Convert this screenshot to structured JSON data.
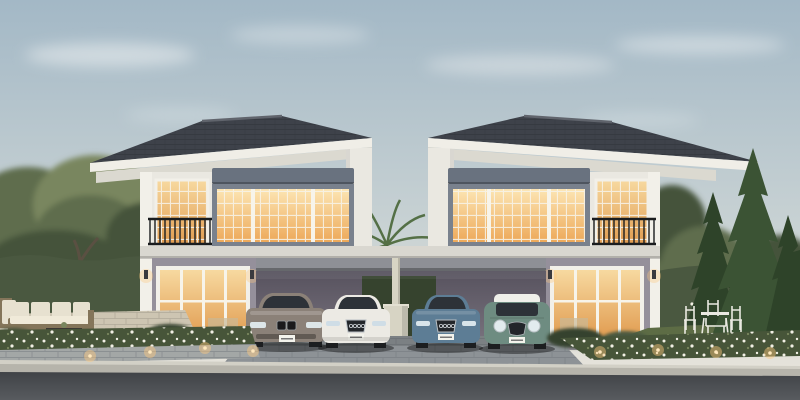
{
  "meta": {
    "description": "Dusk architectural rendering of two mirrored twin two-storey houses with dark hipped roofs, warm-lit windows, balconies, and carports sheltering four cars (grey sedan, white sedan, blue sedan, green mini with white roof). Landscaped garden with hedges, pine trees, a palm, outdoor sofa set, white garden dining set, flower beds with path lights, paver driveway and asphalt road in the foreground."
  },
  "colors": {
    "sky_top": "#a3b8c6",
    "sky_mid": "#c7d1d3",
    "sky_horizon": "#ece7dc",
    "cloud": "#f4f6f6",
    "roof": "#3e424a",
    "roof_ridge": "#60646c",
    "fascia": "#f0eee7",
    "soffit": "#dbd9d0",
    "wall_upper": "#eae8e1",
    "wall_trim": "#f2f0e9",
    "wall_lower": "#95909b",
    "frame_gray": "#79818d",
    "shutter_gray": "#69727f",
    "glow_top": "#fce5b3",
    "glow_bottom": "#eda95a",
    "door_glow_top": "#f7d9a0",
    "door_glow_bottom": "#e09a4e",
    "mullion": "#f7f4ea",
    "railing": "#1a1c1e",
    "slab": "#d9d7d0",
    "beam": "#8e9096",
    "post": "#d7d4c4",
    "carport_top": "#57525e",
    "carport_bottom": "#7b7681",
    "hedge": "#4a5840",
    "hedge_dark": "#36432e",
    "tree_green": "#5e6d4d",
    "tree_dark": "#45533a",
    "tree_light": "#79865e",
    "conifer": "#3b5334",
    "conifer_dark": "#2e4329",
    "palm": "#4e6a3e",
    "grass": "#5d6c45",
    "flowerbed": "#475539",
    "flower": "#f1efe4",
    "patio": "#cdc5b2",
    "paver": "#8d9296",
    "paver_line": "#6e747a",
    "walk": "#a3a7a6",
    "curb": "#b6b4ab",
    "curb_top": "#d2d0c6",
    "road_top": "#404347",
    "road_bottom": "#585b5f",
    "car_gray": "#8b8178",
    "car_white": "#eceae4",
    "car_blue": "#5d7d95",
    "car_mini": "#6e8c81",
    "mini_roof": "#eff0ea",
    "tire": "#1c1e20",
    "glass": "#2d3238",
    "headlight": "#e2ebee",
    "plate": "#f3f3ec",
    "light_warm": "#ffc97e",
    "light_core": "#ffe8bd",
    "wood": "#84755a",
    "cushion": "#e7e1d0",
    "table_dark": "#3a3733",
    "dining": "#eae9e1",
    "trunk": "#5a5042"
  },
  "objects": {
    "left_house": "two-storey house with balcony and carport",
    "right_house": "mirrored twin house",
    "cars": [
      "grey sedan",
      "white sedan",
      "blue sedan",
      "green mini cooper"
    ],
    "garden": [
      "outdoor sofa set",
      "garden dining set",
      "hedges",
      "pine trees",
      "palm tree",
      "flower beds",
      "path lights"
    ]
  }
}
